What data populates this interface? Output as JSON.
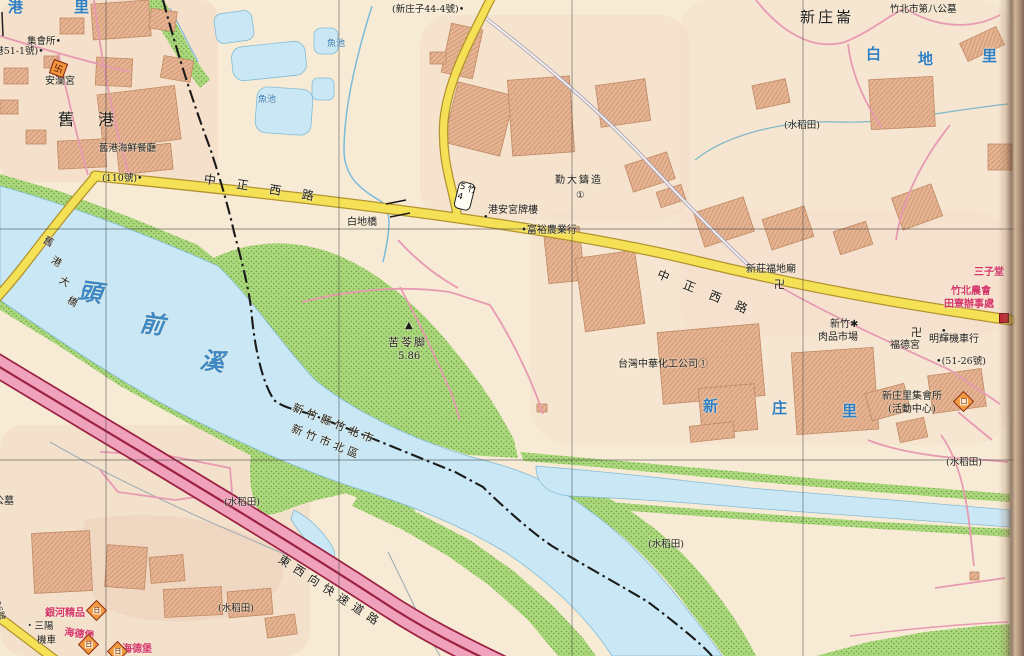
{
  "map_title": "Zhubei / Jiugang area street map (scanned atlas page)",
  "colors": {
    "land": "#f8ebd5",
    "water": "#c9e7f4",
    "green": "#abd87c",
    "road_yellow": "#f5e156",
    "expressway_pink": "#f0a2bd",
    "expressway_line": "#9c2242",
    "building": "#e6b493",
    "blue_text": "#2f7ec2",
    "red_text": "#d5366a",
    "lane_pink": "#e79ab2",
    "boundary": "#1a1a1a"
  },
  "labels": [
    {
      "name": "ward-label-gang",
      "text": "港",
      "x": 8,
      "y": 0,
      "cls": "blue-lg"
    },
    {
      "name": "ward-label-li",
      "text": "里",
      "x": 74,
      "y": 0,
      "cls": "blue-lg"
    },
    {
      "name": "poi-assembly-hall",
      "text": "集會所•",
      "x": 27,
      "y": 37
    },
    {
      "name": "poi-jiugang-51-1",
      "text": "(舊港51-1號)•",
      "x": -19,
      "y": 47
    },
    {
      "name": "poi-anlan-temple",
      "text": "安瀾宮",
      "x": 45,
      "y": 77,
      "size": 10
    },
    {
      "name": "district-jiugang",
      "text": "舊港",
      "x": 58,
      "y": 112,
      "size": 16,
      "ls": 24
    },
    {
      "name": "poi-jiugang-seafood",
      "text": "舊港海鮮餐廳",
      "x": 99,
      "y": 144
    },
    {
      "name": "poi-no110",
      "text": "(110號)•",
      "x": 102,
      "y": 174
    },
    {
      "name": "road-zhongzheng-west-1",
      "text": "中正西路",
      "x": 205,
      "y": 173,
      "size": 12,
      "rot": 9,
      "ls": 21
    },
    {
      "name": "poi-baidi-bridge",
      "text": "白地橋",
      "x": 347,
      "y": 218,
      "size": 10
    },
    {
      "name": "poi-xinzhuangzi-44-4",
      "text": "(新庄子44-4號)•",
      "x": 392,
      "y": 5
    },
    {
      "name": "water-fishpond-1",
      "text": "魚池",
      "x": 327,
      "y": 40,
      "cls": "blue",
      "size": 9
    },
    {
      "name": "water-fishpond-2",
      "text": "魚池",
      "x": 258,
      "y": 96,
      "cls": "blue",
      "size": 9
    },
    {
      "name": "poi-gangan-gong-gate",
      "text": "港安宮牌樓",
      "x": 488,
      "y": 206,
      "size": 10
    },
    {
      "name": "poi-dot-1",
      "text": "•",
      "x": 483,
      "y": 213
    },
    {
      "name": "poi-fuyu-farm",
      "text": "•富裕農業行",
      "x": 521,
      "y": 226,
      "size": 10
    },
    {
      "name": "poi-qinda-foundry",
      "text": "勤大鑄造",
      "x": 555,
      "y": 176,
      "size": 10,
      "ls": 2
    },
    {
      "name": "poi-circled-1a",
      "text": "①",
      "x": 576,
      "y": 191
    },
    {
      "name": "district-xinzhuanglun",
      "text": "新庄崙",
      "x": 800,
      "y": 10,
      "size": 15,
      "ls": 3
    },
    {
      "name": "poi-8th-cemetery",
      "text": "竹北市第八公墓",
      "x": 890,
      "y": 5
    },
    {
      "name": "district-baidi-bai",
      "text": "白",
      "x": 866,
      "y": 47,
      "cls": "blue-lg"
    },
    {
      "name": "district-baidi-di",
      "text": "地",
      "x": 918,
      "y": 52,
      "cls": "blue-lg"
    },
    {
      "name": "district-baidi-li",
      "text": "里",
      "x": 982,
      "y": 49,
      "cls": "blue-lg"
    },
    {
      "name": "land-paddy-1",
      "text": "(水稻田)",
      "x": 784,
      "y": 121
    },
    {
      "name": "poi-fudi-temple",
      "text": "新莊福地廟",
      "x": 746,
      "y": 265,
      "size": 10
    },
    {
      "name": "poi-swastika-1",
      "text": "卍",
      "x": 774,
      "y": 279,
      "size": 11
    },
    {
      "name": "road-zhongzheng-west-2",
      "text": "中正西路",
      "x": 660,
      "y": 268,
      "size": 12,
      "rot": 22,
      "ls": 16
    },
    {
      "name": "poi-sanzi-red",
      "text": "三子堂",
      "x": 974,
      "y": 268,
      "cls": "red",
      "size": 10
    },
    {
      "name": "poi-farmers-assoc-1",
      "text": "竹北農會",
      "x": 951,
      "y": 287,
      "cls": "red",
      "size": 10
    },
    {
      "name": "poi-farmers-assoc-2",
      "text": "田寮辦事處",
      "x": 944,
      "y": 300,
      "cls": "red",
      "size": 10
    },
    {
      "name": "poi-meat-market-1",
      "text": "新竹✱",
      "x": 830,
      "y": 320,
      "size": 10
    },
    {
      "name": "poi-meat-market-2",
      "text": "肉品市場",
      "x": 818,
      "y": 333,
      "size": 10
    },
    {
      "name": "poi-swastika-2",
      "text": "卍",
      "x": 911,
      "y": 327,
      "size": 11
    },
    {
      "name": "poi-fude-temple",
      "text": "福德宮",
      "x": 890,
      "y": 341,
      "size": 10
    },
    {
      "name": "poi-minghui-motors",
      "text": "明輝機車行",
      "x": 929,
      "y": 335,
      "size": 10
    },
    {
      "name": "poi-dot-2",
      "text": "•",
      "x": 941,
      "y": 327
    },
    {
      "name": "poi-no51-26",
      "text": "•(51-26號)",
      "x": 936,
      "y": 357
    },
    {
      "name": "poi-taiwan-chem",
      "text": "台灣中華化工公司①",
      "x": 618,
      "y": 360,
      "size": 10
    },
    {
      "name": "district-xinzhuangli-xin",
      "text": "新",
      "x": 703,
      "y": 399,
      "cls": "blue-lg"
    },
    {
      "name": "district-xinzhuangli-zhuang",
      "text": "庄",
      "x": 772,
      "y": 401,
      "cls": "blue-lg"
    },
    {
      "name": "district-xinzhuangli-li",
      "text": "里",
      "x": 842,
      "y": 404,
      "cls": "blue-lg"
    },
    {
      "name": "poi-xinzhuangli-hall-1",
      "text": "新庄里集會所",
      "x": 882,
      "y": 392,
      "size": 10
    },
    {
      "name": "poi-xinzhuangli-hall-2",
      "text": "(活動中心)",
      "x": 888,
      "y": 405,
      "size": 10
    },
    {
      "name": "land-paddy-2",
      "text": "(水稻田)",
      "x": 946,
      "y": 458
    },
    {
      "name": "land-paddy-3",
      "text": "(水稻田)",
      "x": 648,
      "y": 540
    },
    {
      "name": "land-paddy-4",
      "text": "(水稻田)",
      "x": 224,
      "y": 498
    },
    {
      "name": "land-paddy-5",
      "text": "(水稻田)",
      "x": 218,
      "y": 604
    },
    {
      "name": "poi-triangulation",
      "text": "▲",
      "x": 405,
      "y": 321,
      "size": 10
    },
    {
      "name": "poi-kulingjiao",
      "text": "苦苓脚",
      "x": 388,
      "y": 337,
      "size": 11,
      "ls": 2
    },
    {
      "name": "poi-elevation",
      "text": "5.86",
      "x": 398,
      "y": 352,
      "size": 10
    },
    {
      "name": "river-touqianxi-tou",
      "text": "頭",
      "x": 80,
      "y": 278,
      "cls": "river-name",
      "rot": 8
    },
    {
      "name": "river-touqianxi-qian",
      "text": "前",
      "x": 142,
      "y": 310,
      "cls": "river-name",
      "rot": 8
    },
    {
      "name": "river-touqianxi-xi",
      "text": "溪",
      "x": 202,
      "y": 347,
      "cls": "river-name",
      "rot": 8
    },
    {
      "name": "bridge-jiugang-1",
      "text": "舊",
      "x": 46,
      "y": 236,
      "size": 10,
      "rot": 30
    },
    {
      "name": "bridge-jiugang-2",
      "text": "港",
      "x": 54,
      "y": 256,
      "size": 10,
      "rot": 30
    },
    {
      "name": "bridge-jiugang-3",
      "text": "大",
      "x": 62,
      "y": 276,
      "size": 10,
      "rot": 30
    },
    {
      "name": "bridge-jiugang-4",
      "text": "橋",
      "x": 70,
      "y": 296,
      "size": 10,
      "rot": 30
    },
    {
      "name": "boundary-label-zhubei",
      "text": "新竹縣竹北市",
      "x": 295,
      "y": 402,
      "size": 11,
      "rot": 22,
      "ls": 4
    },
    {
      "name": "boundary-label-north-dist",
      "text": "新竹市北區",
      "x": 294,
      "y": 423,
      "size": 11,
      "rot": 22,
      "ls": 4
    },
    {
      "name": "road-expressway-label",
      "text": "東西向快速道路",
      "x": 283,
      "y": 553,
      "size": 11.5,
      "rot": 33,
      "ls": 6
    },
    {
      "name": "poi-cemetery-left",
      "text": "公墓",
      "x": -6,
      "y": 497,
      "size": 10
    },
    {
      "name": "poi-yinhe-boutique",
      "text": "銀河精品",
      "x": 45,
      "y": 609,
      "cls": "red",
      "size": 10
    },
    {
      "name": "poi-sanyang-1",
      "text": "・三陽",
      "x": 25,
      "y": 622
    },
    {
      "name": "poi-sanyang-2",
      "text": "機車",
      "x": 37,
      "y": 636
    },
    {
      "name": "poi-haidebao-1",
      "text": "海德堡",
      "x": 65,
      "y": 628,
      "cls": "red",
      "size": 10,
      "rot": 8
    },
    {
      "name": "poi-haidebao-2",
      "text": "海德堡",
      "x": 122,
      "y": 645,
      "cls": "red",
      "size": 10
    },
    {
      "name": "poi-no556",
      "text": "(556號",
      "x": -3,
      "y": 592,
      "size": 8.5,
      "rot": 72
    }
  ],
  "icons": [
    {
      "name": "road-shield-zhu54",
      "type": "shield",
      "text": "竹54",
      "x": 456,
      "y": 182,
      "rot": 14
    },
    {
      "name": "temple-icon-anlangong",
      "type": "temple",
      "text": "卐",
      "x": 51,
      "y": 61
    },
    {
      "name": "hotel-icon-1",
      "type": "diamond",
      "text": "日",
      "x": 89,
      "y": 603
    },
    {
      "name": "hotel-icon-2",
      "type": "diamond",
      "text": "日",
      "x": 81,
      "y": 637
    },
    {
      "name": "hotel-icon-3",
      "type": "diamond",
      "text": "日",
      "x": 110,
      "y": 644
    },
    {
      "name": "hall-icon-xinzhuangli",
      "type": "diamond",
      "text": "口",
      "x": 956,
      "y": 394
    },
    {
      "name": "office-icon-farmers",
      "type": "redsq",
      "text": "",
      "x": 999,
      "y": 313
    }
  ]
}
